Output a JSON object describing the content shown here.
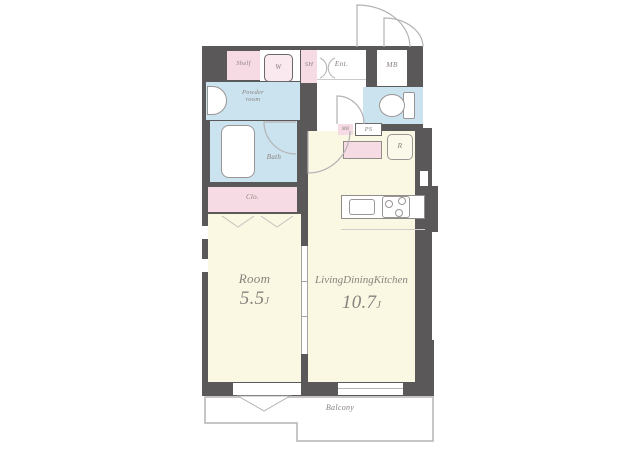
{
  "colors": {
    "wall": "#5b5859",
    "room_floor": "#faf7e3",
    "wet_area_floor": "#cbe2ef",
    "storage_pink": "#f7dbe4",
    "fixture_outline": "#9a9695",
    "label_text": "#8a827e",
    "balcony_outline": "#b5b2b4"
  },
  "plan": {
    "shelf": {
      "label": "Shelf"
    },
    "washing_machine": {
      "label": "W"
    },
    "shoe_shelf": {
      "label": "SH"
    },
    "entrance": {
      "label": "Ent."
    },
    "meter_box": {
      "label": "MB"
    },
    "powder_room": {
      "line1": "Powder",
      "line2": "room"
    },
    "bath": {
      "label": "Bath"
    },
    "closet": {
      "label": "Clo."
    },
    "pipe_space": {
      "label": "PS"
    },
    "meter_box_small": {
      "label": "MB"
    },
    "refrigerator": {
      "label": "R"
    },
    "room": {
      "name": "Room",
      "area": "5.5",
      "unit": "J"
    },
    "ldk": {
      "name": "LivingDiningKitchen",
      "area": "10.7",
      "unit": "J"
    },
    "balcony": {
      "label": "Balcony"
    }
  }
}
